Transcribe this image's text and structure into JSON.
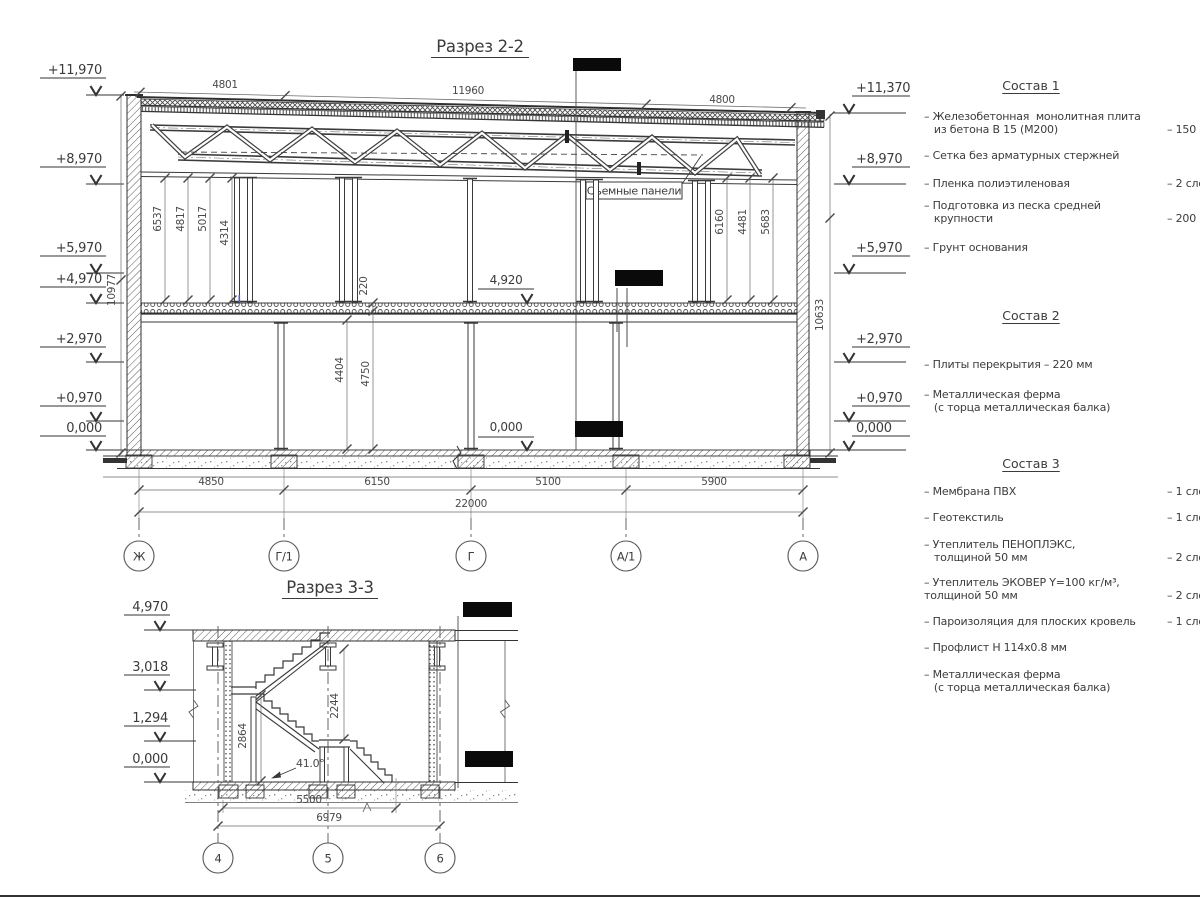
{
  "section2": {
    "title": "Разрез 2-2",
    "elevations_left": [
      "+11,970",
      "+8,970",
      "+5,970",
      "+4,970",
      "+2,970",
      "+0,970",
      "0,000"
    ],
    "elevations_right": [
      "+11,370",
      "+8,970",
      "+5,970",
      "+2,970",
      "+0,970",
      "0,000"
    ],
    "roof_dims": [
      "4801",
      "11960",
      "4800"
    ],
    "height_dims_left": [
      "6537",
      "4817",
      "5017",
      "4314"
    ],
    "height_dims_right": [
      "6160",
      "4481",
      "5683"
    ],
    "overall_height_left": "10977",
    "overall_height_right": "10633",
    "slab_thickness": "220",
    "clear_heights": [
      "4404",
      "4750"
    ],
    "floor_mark": "4,920",
    "ground_mark": "0,000",
    "panel_callout": "Съемные панели",
    "bottom_dims": [
      "4850",
      "6150",
      "5100",
      "5900"
    ],
    "total_dim": "22000",
    "axes": [
      "Ж",
      "Г/1",
      "Г",
      "А/1",
      "А"
    ]
  },
  "section3": {
    "title": "Разрез 3-3",
    "elevations": [
      "4,970",
      "3,018",
      "1,294",
      "0,000"
    ],
    "stair_dims": [
      "2864",
      "2244"
    ],
    "stair_angle": "41.0°",
    "bottom_dims": [
      "5500",
      "6979"
    ],
    "axes": [
      "4",
      "5",
      "6"
    ]
  },
  "legend": {
    "compositions": [
      {
        "title": "Состав 1",
        "items": [
          {
            "name": "– Железобетонная  монолитная плита\n   из бетона В 15 (М200)",
            "value": "– 150 мм"
          },
          {
            "name": "– Сетка без арматурных стержней",
            "value": ""
          },
          {
            "name": "– Пленка полиэтиленовая",
            "value": "– 2 слоя"
          },
          {
            "name": "– Подготовка из песка средней\n   крупности",
            "value": "– 200 мм"
          },
          {
            "name": "– Грунт основания",
            "value": ""
          }
        ]
      },
      {
        "title": "Состав 2",
        "items": [
          {
            "name": "– Плиты перекрытия – 220 мм",
            "value": ""
          },
          {
            "name": "– Металлическая ферма\n   (с торца металлическая балка)",
            "value": ""
          }
        ]
      },
      {
        "title": "Состав 3",
        "items": [
          {
            "name": "– Мембрана ПВХ",
            "value": "– 1 слой"
          },
          {
            "name": "– Геотекстиль",
            "value": "– 1 слой"
          },
          {
            "name": "– Утеплитель ПЕНОПЛЭКС,\n   толщиной 50 мм",
            "value": "– 2 слоя"
          },
          {
            "name": "– Утеплитель ЭКОВЕР Y=100 кг/м³,\nтолщиной 50 мм",
            "value": "– 2 слоя"
          },
          {
            "name": "– Пароизоляция для плоских кровель",
            "value": "– 1 слой"
          },
          {
            "name": "– Профлист Н 114х0.8 мм",
            "value": ""
          },
          {
            "name": "– Металлическая ферма\n   (с торца металлическая балка)",
            "value": ""
          }
        ]
      }
    ]
  }
}
